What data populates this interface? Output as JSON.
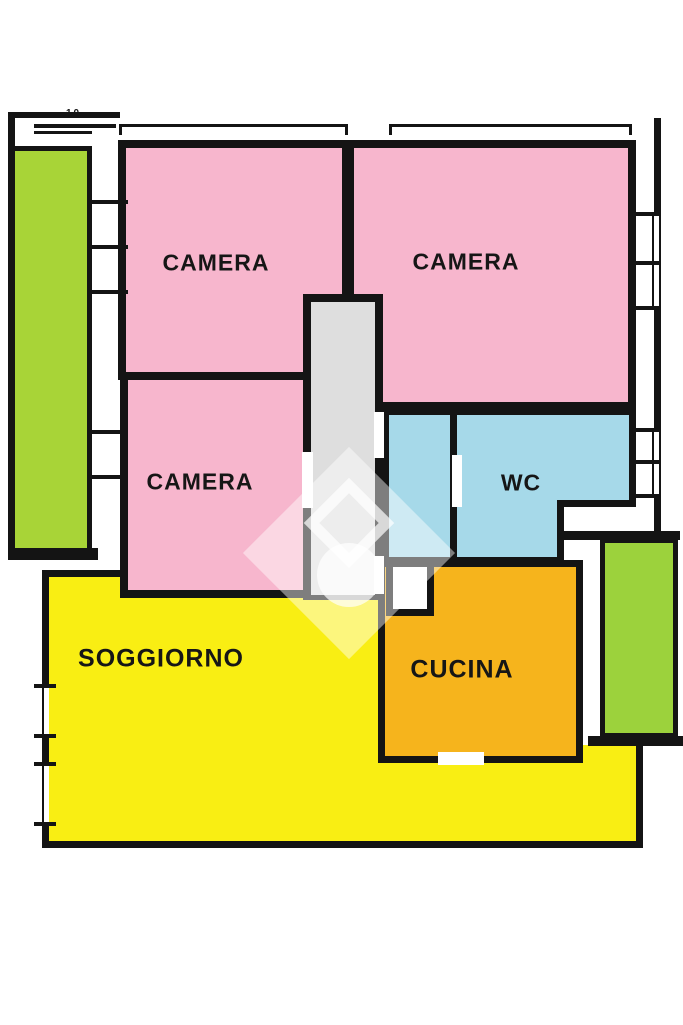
{
  "plan": {
    "title": "apartment-floor-plan",
    "rooms": [
      {
        "id": "camera-top-left",
        "label": "CAMERA",
        "color": "#f7b6cd"
      },
      {
        "id": "camera-top-right",
        "label": "CAMERA",
        "color": "#f7b6cd"
      },
      {
        "id": "camera-mid-left",
        "label": "CAMERA",
        "color": "#f7b6cd"
      },
      {
        "id": "wc",
        "label": "WC",
        "color": "#a6d9e9"
      },
      {
        "id": "soggiorno",
        "label": "SOGGIORNO",
        "color": "#f9ee13"
      },
      {
        "id": "cucina",
        "label": "CUCINA",
        "color": "#f6b41c"
      },
      {
        "id": "balcony-left",
        "label": "",
        "color": "#a8d437"
      },
      {
        "id": "balcony-right",
        "label": "",
        "color": "#9cd23c"
      }
    ],
    "corridor_color": "#dedede",
    "wall_color": "#141414",
    "dimension_label": "10",
    "watermark": "house-logo-diamond"
  }
}
